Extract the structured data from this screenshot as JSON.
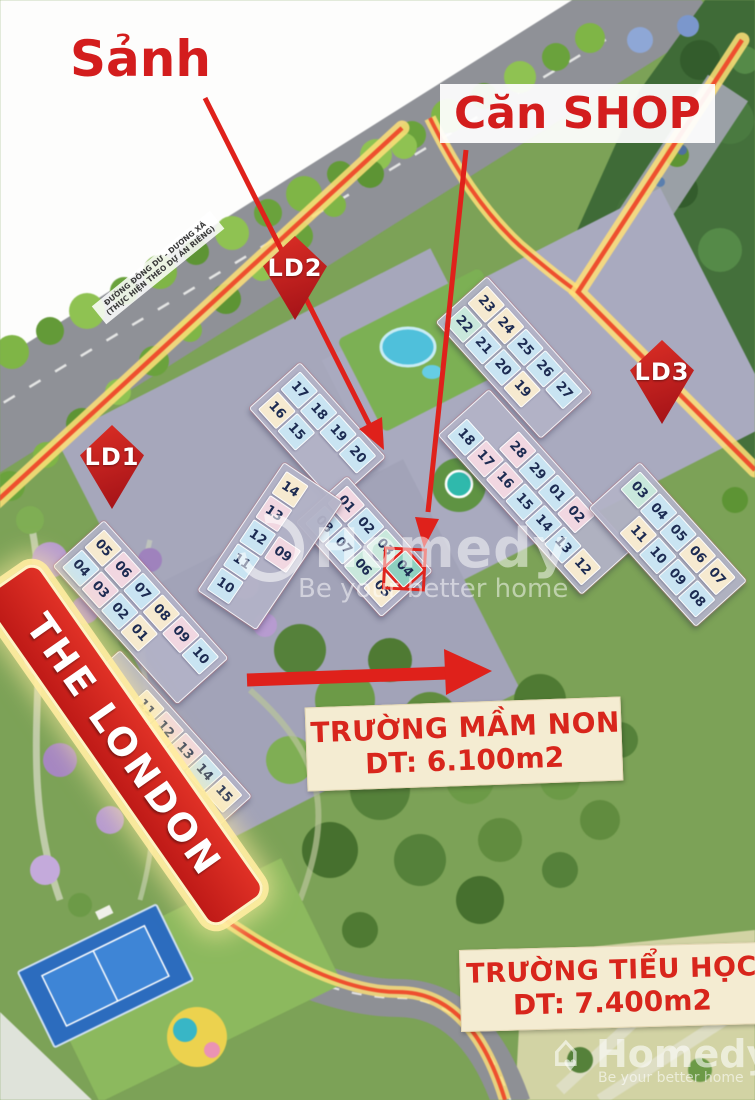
{
  "annotations": {
    "lobby_label": "Sảnh",
    "shop_label": "Căn SHOP"
  },
  "markers": [
    {
      "label": "LD1"
    },
    {
      "label": "LD2"
    },
    {
      "label": "LD3"
    }
  ],
  "banner": {
    "text": "THE LONDON"
  },
  "schools": [
    {
      "name": "TRƯỜNG MẦM NON",
      "area": "DT: 6.100m2"
    },
    {
      "name": "TRƯỜNG TIỂU HỌC",
      "area": "DT: 7.400m2"
    }
  ],
  "road_label": {
    "line1": "ĐƯỜNG ĐÔNG DƯ - DƯƠNG XÁ",
    "line2": "(THỰC HIỆN THEO DỰ ÁN RIÊNG)"
  },
  "watermark": {
    "brand": "Homedy",
    "tagline": "Be your better home"
  },
  "tile_colors": {
    "b": "#c9e4f2",
    "c": "#f6ead0",
    "p": "#f1d7e1",
    "t": "#c9e8dc",
    "h": "#8fd0c0"
  },
  "accent": {
    "annotation_red": "#d31d1d",
    "marker_red": "#c2191f",
    "banner_red": "#d1261f",
    "boundary_glow": "#ffe178",
    "boundary_line": "#ee4f2e",
    "school_text_red": "#d8261c"
  },
  "buildings": [
    {
      "name": "west-upper",
      "x": 104,
      "y": 520,
      "rot": 48,
      "rows": [
        {
          "tiles": [
            {
              "n": "05",
              "c": "c"
            },
            {
              "n": "06",
              "c": "p"
            },
            {
              "n": "07",
              "c": "b"
            },
            {
              "n": "08",
              "c": "c"
            },
            {
              "n": "09",
              "c": "p"
            },
            {
              "n": "10",
              "c": "b"
            }
          ]
        },
        {
          "tiles": [
            {
              "n": "04",
              "c": "b"
            },
            {
              "n": "03",
              "c": "p"
            },
            {
              "n": "02",
              "c": "b"
            },
            {
              "n": "01",
              "c": "c"
            }
          ]
        }
      ]
    },
    {
      "name": "west-lower",
      "x": 120,
      "y": 650,
      "rot": 48,
      "rows": [
        {
          "ml": 40,
          "tiles": [
            {
              "n": "11",
              "c": "c"
            },
            {
              "n": "12",
              "c": "p"
            },
            {
              "n": "13",
              "c": "p"
            },
            {
              "n": "14",
              "c": "b"
            },
            {
              "n": "15",
              "c": "c"
            }
          ]
        },
        {
          "tiles": [
            {
              "n": "19",
              "c": "b"
            },
            {
              "n": "18",
              "c": "b"
            },
            {
              "n": "17",
              "c": "b"
            },
            {
              "n": "16",
              "c": "c"
            }
          ]
        }
      ]
    },
    {
      "name": "center-upper",
      "x": 300,
      "y": 362,
      "rot": 48,
      "rows": [
        {
          "tiles": [
            {
              "n": "17",
              "c": "b"
            },
            {
              "n": "18",
              "c": "b"
            },
            {
              "n": "19",
              "c": "b"
            },
            {
              "n": "20",
              "c": "b"
            }
          ]
        },
        {
          "tiles": [
            {
              "n": "16",
              "c": "c"
            },
            {
              "n": "15",
              "c": "b"
            }
          ]
        }
      ]
    },
    {
      "name": "center-lower",
      "x": 347,
      "y": 476,
      "rot": 48,
      "rows": [
        {
          "tiles": [
            {
              "n": "01",
              "c": "p"
            },
            {
              "n": "02",
              "c": "b"
            },
            {
              "n": "03",
              "c": "t"
            },
            {
              "n": "04",
              "c": "h",
              "hl": true
            }
          ]
        },
        {
          "tiles": [
            {
              "n": "08",
              "c": "b"
            },
            {
              "n": "07",
              "c": "b"
            },
            {
              "n": "06",
              "c": "t"
            },
            {
              "n": "05",
              "c": "c"
            }
          ]
        }
      ]
    },
    {
      "name": "center-west",
      "x": 284,
      "y": 462,
      "rot": 34,
      "col": true,
      "rows": [
        {
          "tiles": [
            {
              "n": "14",
              "c": "c"
            },
            {
              "n": "13",
              "c": "p"
            },
            {
              "n": "12",
              "c": "b"
            },
            {
              "n": "11",
              "c": "b"
            },
            {
              "n": "10",
              "c": "b"
            }
          ]
        },
        {
          "mt": 58,
          "tiles": [
            {
              "n": "09",
              "c": "p"
            }
          ]
        }
      ]
    },
    {
      "name": "east-upper",
      "x": 487,
      "y": 276,
      "rot": 48,
      "rows": [
        {
          "tiles": [
            {
              "n": "23",
              "c": "c"
            },
            {
              "n": "24",
              "c": "c"
            },
            {
              "n": "25",
              "c": "b"
            },
            {
              "n": "26",
              "c": "b"
            },
            {
              "n": "27",
              "c": "b"
            }
          ]
        },
        {
          "tiles": [
            {
              "n": "22",
              "c": "t"
            },
            {
              "n": "21",
              "c": "b"
            },
            {
              "n": "20",
              "c": "b"
            },
            {
              "n": "19",
              "c": "c"
            }
          ]
        }
      ]
    },
    {
      "name": "east-stem",
      "x": 489,
      "y": 389,
      "rot": 48,
      "rows": [
        {
          "ml": 44,
          "tiles": [
            {
              "n": "28",
              "c": "p"
            },
            {
              "n": "29",
              "c": "b"
            },
            {
              "n": "01",
              "c": "b"
            },
            {
              "n": "02",
              "c": "p"
            }
          ]
        },
        {
          "tiles": [
            {
              "n": "18",
              "c": "b"
            },
            {
              "n": "17",
              "c": "p"
            },
            {
              "n": "16",
              "c": "p"
            },
            {
              "n": "15",
              "c": "b"
            },
            {
              "n": "14",
              "c": "b"
            },
            {
              "n": "13",
              "c": "b"
            },
            {
              "n": "12",
              "c": "c"
            }
          ]
        }
      ]
    },
    {
      "name": "east-east",
      "x": 640,
      "y": 462,
      "rot": 48,
      "rows": [
        {
          "tiles": [
            {
              "n": "03",
              "c": "t"
            },
            {
              "n": "04",
              "c": "b"
            },
            {
              "n": "05",
              "c": "b"
            },
            {
              "n": "06",
              "c": "c"
            },
            {
              "n": "07",
              "c": "c"
            }
          ]
        },
        {
          "ml": 32,
          "tiles": [
            {
              "n": "11",
              "c": "c"
            },
            {
              "n": "10",
              "c": "b"
            },
            {
              "n": "09",
              "c": "b"
            },
            {
              "n": "08",
              "c": "b"
            }
          ]
        }
      ]
    }
  ]
}
